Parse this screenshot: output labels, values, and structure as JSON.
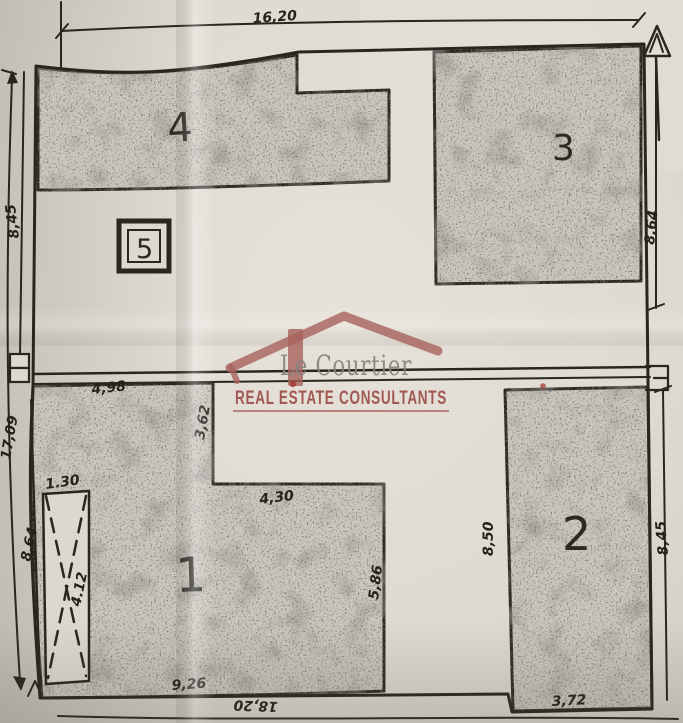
{
  "plan": {
    "units": [
      {
        "id": "unit-1",
        "label": "1"
      },
      {
        "id": "unit-2",
        "label": "2"
      },
      {
        "id": "unit-3",
        "label": "3"
      },
      {
        "id": "unit-4",
        "label": "4"
      },
      {
        "id": "unit-5",
        "label": "5"
      }
    ],
    "dimensions": {
      "top_width": "16,20",
      "left_upper": "8,45",
      "left_total": "17,09",
      "left_lower": "8,64",
      "right_upper": "8,64",
      "right_lower": "8,45",
      "unit1_top": "4,98",
      "notch_left": "3,62",
      "notch_bottom": "4,30",
      "unit1_right": "5,86",
      "unit2_left": "8,50",
      "unit2_bottom": "3,72",
      "ramp_width": "1.30",
      "ramp_length": "4.12",
      "bottom_left": "9,26",
      "bottom_total": "18,20"
    }
  },
  "watermark": {
    "brand": "Le Courtier",
    "tagline": "REAL ESTATE CONSULTANTS",
    "colors": {
      "roof": "#a8625c",
      "brand_text": "#878480",
      "tagline_text": "#9e514b"
    }
  },
  "colors": {
    "paper": "#e0dcd4",
    "ink": "#29261f",
    "parcel_fill": "#cbc7be"
  }
}
